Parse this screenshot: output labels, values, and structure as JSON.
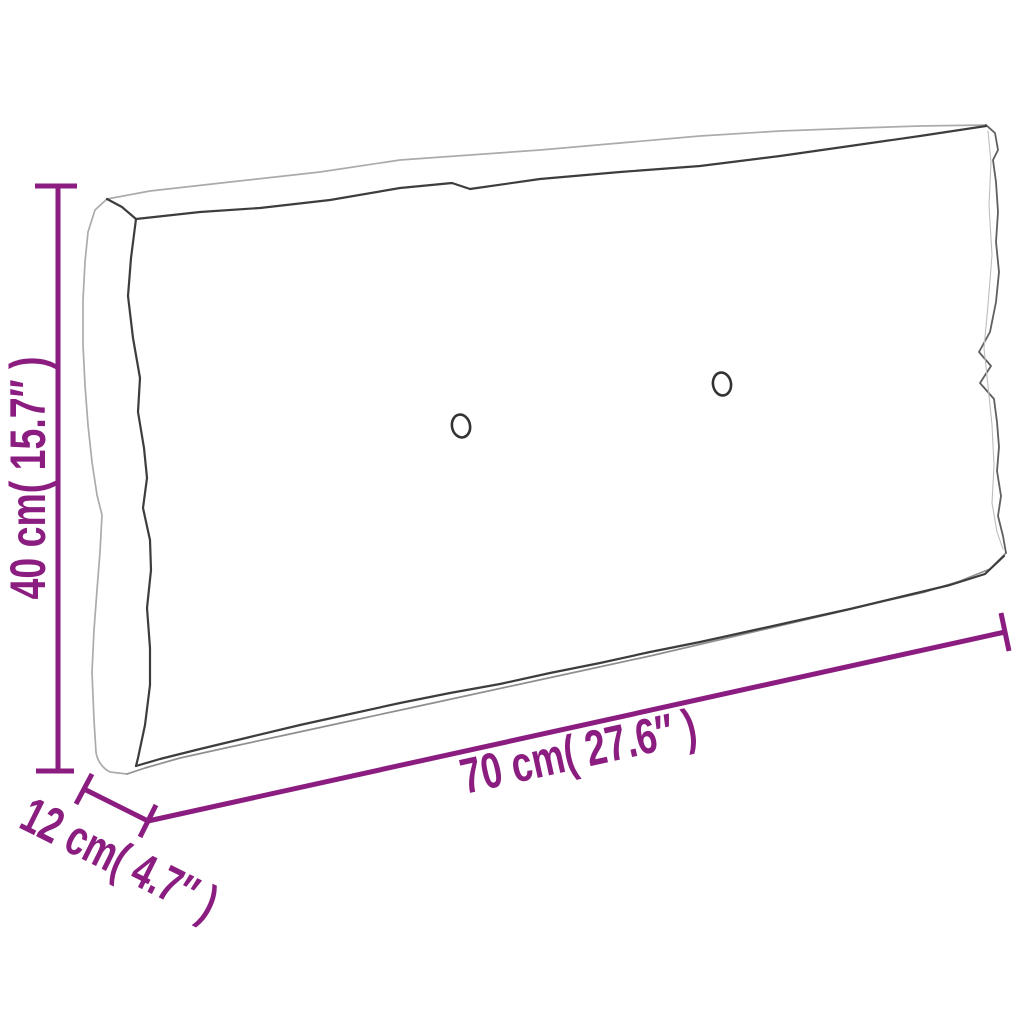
{
  "diagram": {
    "description": "Outline drawing of a rectangular pallet cushion shown in perspective with tufting buttons and purple dimension lines",
    "background_color": "#ffffff",
    "dimension_color": "#8b1d81",
    "outline_light_color": "#ababab",
    "outline_dark_color": "#3d3d3d",
    "dimensions": {
      "height": {
        "label": "40 cm( 15.7″ )",
        "metric": "40 cm",
        "imperial": "15.7″"
      },
      "length": {
        "label": "70 cm( 27.6″ )",
        "metric": "70 cm",
        "imperial": "27.6″"
      },
      "depth": {
        "label": "12 cm( 4.7″ )",
        "metric": "12 cm",
        "imperial": "4.7″"
      }
    },
    "features": {
      "tufting_buttons": 2
    }
  }
}
